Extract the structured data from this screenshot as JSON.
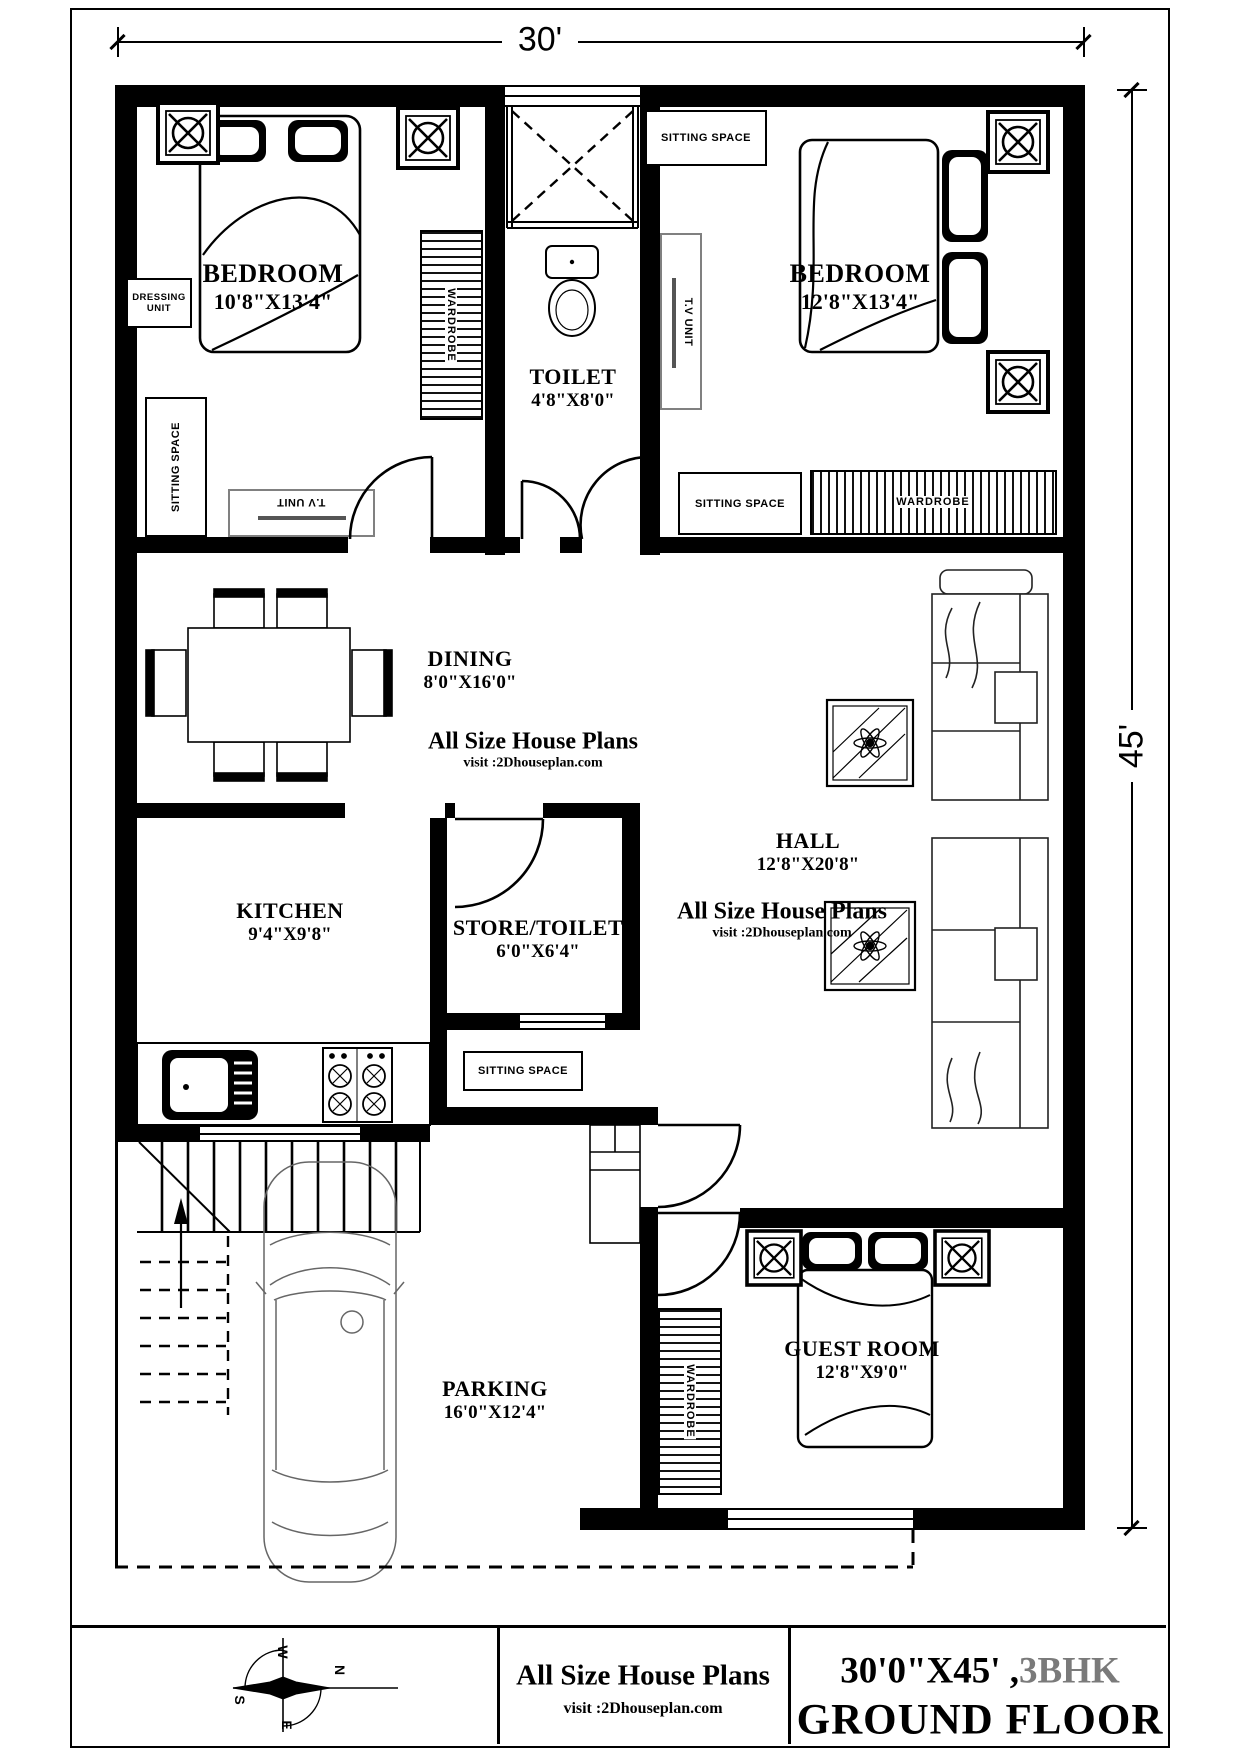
{
  "dimensions": {
    "width_label": "30'",
    "height_label": "45'"
  },
  "rooms": {
    "bedroom1": {
      "name": "BEDROOM",
      "size": "10'8\"X13'4\""
    },
    "bedroom2": {
      "name": "BEDROOM",
      "size": "12'8\"X13'4\""
    },
    "toilet": {
      "name": "TOILET",
      "size": "4'8\"X8'0\""
    },
    "dining": {
      "name": "DINING",
      "size": "8'0\"X16'0\""
    },
    "hall": {
      "name": "HALL",
      "size": "12'8\"X20'8\""
    },
    "kitchen": {
      "name": "KITCHEN",
      "size": "9'4\"X9'8\""
    },
    "store_toilet": {
      "name": "STORE/TOILET",
      "size": "6'0\"X6'4\""
    },
    "guest_room": {
      "name": "GUEST ROOM",
      "size": "12'8\"X9'0\""
    },
    "parking": {
      "name": "PARKING",
      "size": "16'0\"X12'4\""
    }
  },
  "labels": {
    "sitting_space": "SITTING SPACE",
    "dressing_unit": "DRESSING UNIT",
    "wardrobe": "WARDROBE",
    "tv_unit": "T.V UNIT"
  },
  "watermark": {
    "title": "All Size House Plans",
    "subtitle": "visit :2Dhouseplan.com"
  },
  "title_block": {
    "brand": "All Size House Plans",
    "brand_sub": "visit :2Dhouseplan.com",
    "plot": "30'0\"X45' ,",
    "bhk": "3BHK",
    "floor": "GROUND FLOOR",
    "compass": {
      "n": "N",
      "s": "S",
      "e": "E",
      "w": "W"
    }
  },
  "colors": {
    "wall": "#000000",
    "bhk_gray": "#7a7a7a"
  }
}
